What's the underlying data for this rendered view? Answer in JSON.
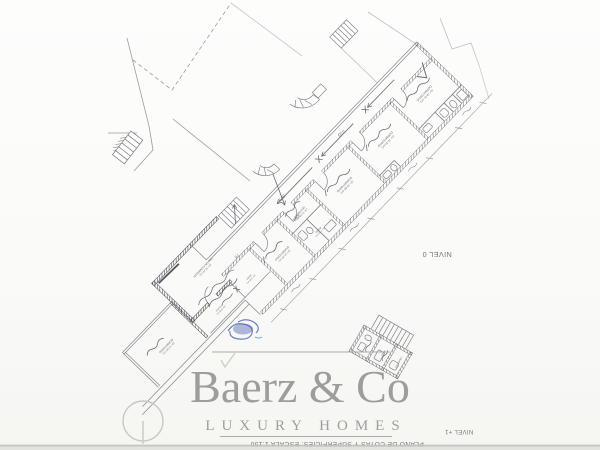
{
  "watermark": {
    "brand": "Baerz & Co",
    "tagline": "LUXURY HOMES"
  },
  "titles": {
    "level_plan": "NIVEL 0",
    "level_footer": "NIVEL +1",
    "plan_caption": "PLANO DE COTAS Y SUPERFICIES. ESCALA 1:150"
  },
  "plan": {
    "rooms": [
      {
        "name": "DORMITORIO",
        "area": "(S= 18.51 m²)"
      },
      {
        "name": "DORMITORIO",
        "area": "(S= 16.30 m²)"
      },
      {
        "name": "DORMITORIO",
        "area": "(S= 15.85 m²)"
      },
      {
        "name": "VESTIBULO",
        "area": "(S= 21.65 m²)"
      },
      {
        "name": "BAÑO",
        "area": "(S= 4.10 m²)"
      },
      {
        "name": "DORMITORIO",
        "area": "(S= 14.20 m²)"
      },
      {
        "name": "SALON-COMEDOR",
        "area": "(S= 32.40 m²)"
      },
      {
        "name": "DORMITORIO",
        "area": "(S= 17.05 m²)"
      },
      {
        "name": "COCINA",
        "area": "(S= 9.80 m²)"
      },
      {
        "name": "BAÑO",
        "area": "(S= 3.95 m²)"
      },
      {
        "name": "ASEO",
        "area": "(S= 5.20 m²)"
      },
      {
        "name": "LAVADERO",
        "area": "(S= 6.10 m²)"
      }
    ],
    "handwritten_dims": [
      "5'23",
      "59'9",
      "6'65",
      "7'5"
    ]
  },
  "colors": {
    "ink": "#8b8b92",
    "wall": "#4c4c54",
    "pencil": "#6a6a72",
    "blue_ink": "#4a63b5",
    "watermark_gray": "#8a8a8a"
  }
}
